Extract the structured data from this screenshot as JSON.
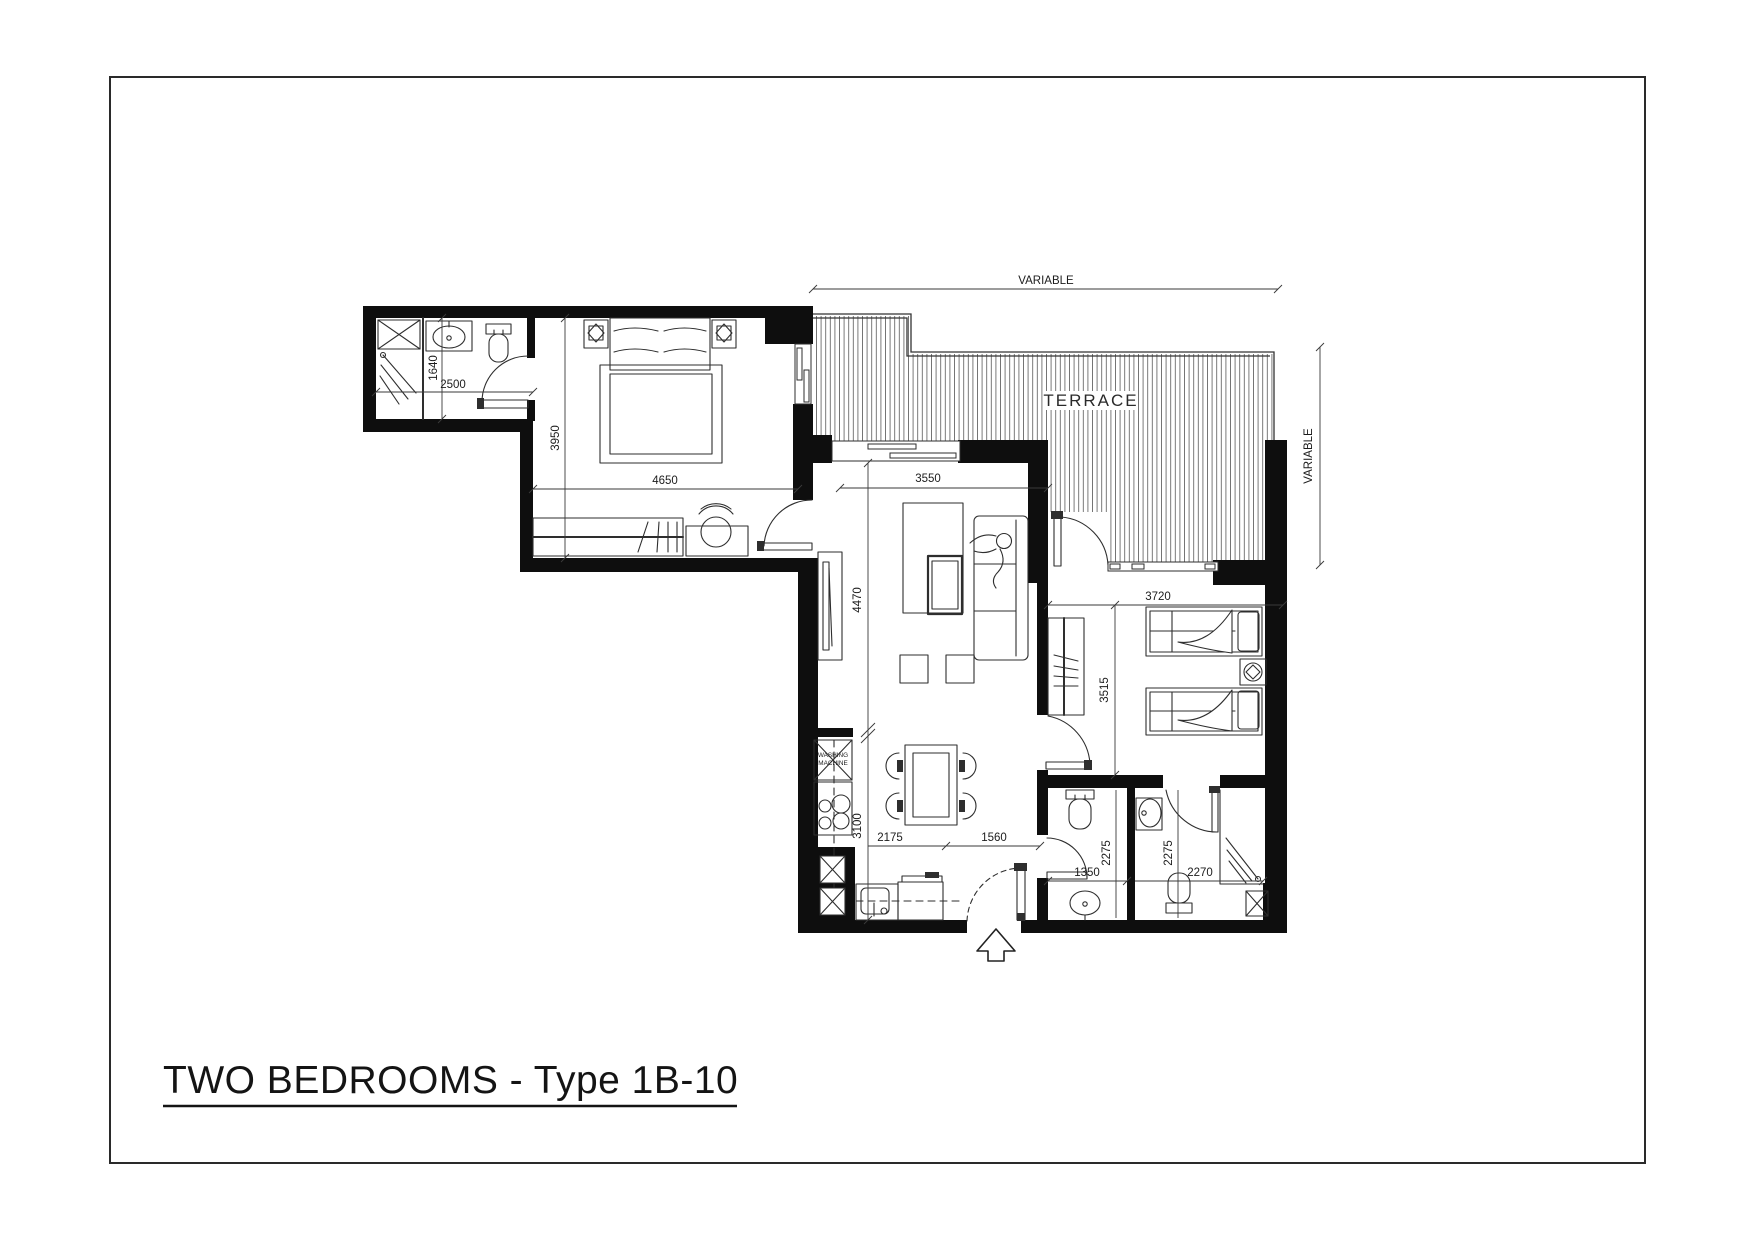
{
  "title": {
    "text": "TWO BEDROOMS - Type 1B-10"
  },
  "labels": {
    "terrace": "TERRACE",
    "washing_machine_line1": "WASHING",
    "washing_machine_line2": "MACHINE"
  },
  "dimensions": {
    "terrace_width": "VARIABLE",
    "terrace_depth": "VARIABLE",
    "master_bedroom_width": "4650",
    "master_bedroom_depth": "3950",
    "master_bath_width": "2500",
    "master_bath_depth": "1640",
    "living_width": "3550",
    "living_depth": "4470",
    "kitchen_depth": "3100",
    "dining_width": "2175",
    "entry_width": "1560",
    "bedroom2_width": "3720",
    "bedroom2_depth": "3515",
    "bath1_width": "1350",
    "bath1_depth": "2275",
    "bath2_depth": "2275",
    "bath2_width": "2270"
  },
  "colors": {
    "drawing_ink": "#111111",
    "hatch_line": "#666666",
    "background": "#ffffff"
  }
}
